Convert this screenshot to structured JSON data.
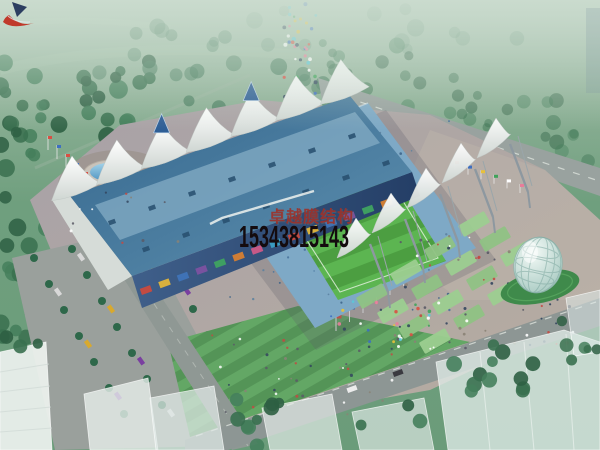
{
  "watermark": {
    "company_name": "卓越膜结构",
    "phone_number": "15343815143",
    "name_color": "#9c332c",
    "phone_color": "#140b0e",
    "logo_red": "#c0392b",
    "logo_navy": "#2c3e60"
  },
  "scene": {
    "description": "Aerial bird's-eye architectural rendering of a stadium with white tensile membrane roofs, blue grandstand roof, green pitch, plaza, fountain, glass egg pavilion, roads, parking and trees",
    "palette": {
      "field_green": "#6f9f7e",
      "tree_green": "#39704f",
      "pitch_green": "#4c9e41",
      "pitch_stripe": "#5cb551",
      "stand_roof_blue": "#4a7b9d",
      "membrane_white": "#f1f3ef",
      "seating_blue": "#7ea9c6",
      "facade_blue": "#31507a",
      "terrace_green": "#8fc284",
      "plaza_gray": "#aaa3a8",
      "road_gray": "#99a29f",
      "fountain_water_blue": "#6fb0d8",
      "glass_egg": "#bcd8d2"
    }
  }
}
